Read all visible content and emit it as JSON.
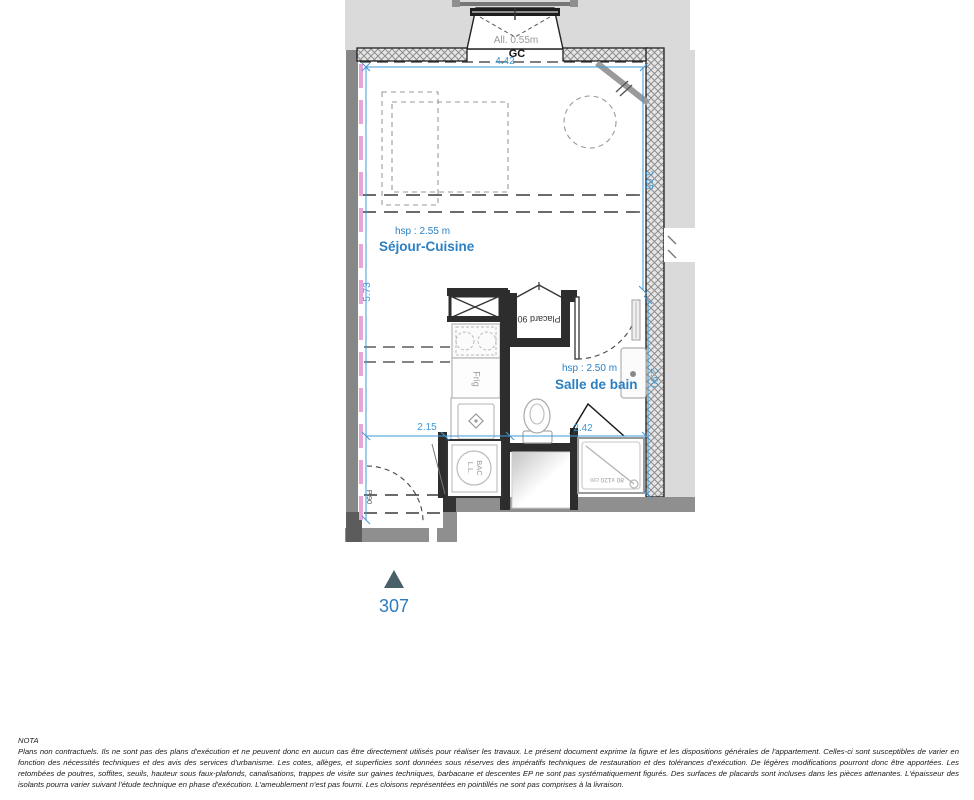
{
  "colors": {
    "dimension_blue": "#3f9ad6",
    "label_blue": "#2b80c4",
    "insulation_pink": "#e7a6da",
    "exterior_gray": "#dadada",
    "wall_gray": "#8f8f8f",
    "dark_wall": "#2d2d2d",
    "entrance_marker": "#4a6068"
  },
  "plan": {
    "window": {
      "sill_label": "All. 0.55m",
      "gc_label": "GC"
    },
    "rooms": {
      "sejour": {
        "name": "Séjour-Cuisine",
        "height_label": "hsp : 2.55 m"
      },
      "bathroom": {
        "name": "Salle de bain",
        "height_label": "hsp : 2.50 m"
      }
    },
    "fixtures": {
      "placard": "Placard 90",
      "fridge": "Frig",
      "washer_line1": "BAC",
      "washer_line2": "L.L.",
      "shower": "80 x120 cm",
      "entry_door": "P.90"
    },
    "dimensions": {
      "width_top": "4.42",
      "height_left": "5.73",
      "height_right_upper": "3.65",
      "height_right_lower": "2.90",
      "width_bottom_left": "2.15",
      "width_bottom_right": "2.42"
    },
    "unit_number": "307"
  },
  "nota": {
    "title": "NOTA",
    "body": "Plans non contractuels. Ils ne sont pas des plans d'exécution et ne peuvent donc en aucun cas être directement utilisés pour réaliser les travaux. Le présent document exprime la figure et les dispositions générales de l'appartement. Celles-ci sont susceptibles de varier en fonction des nécessités techniques et des avis des services d'urbanisme. Les cotes, allèges, et superficies sont données sous réserves des impératifs techniques de restauration et des tolérances d'exécution. De légères modifications pourront donc être apportées. Les retombées de poutres, soffites, seuils, hauteur sous faux-plafonds, canalisations, trappes de visite sur gaines techniques, barbacane et descentes EP ne sont pas systématiquement figurés. Des surfaces de placards sont incluses dans les pièces attenantes. L'épaisseur des isolants pourra varier suivant l'étude technique en phase d'exécution. L'ameublement n'est pas fourni. Les cloisons représentées en pointillés ne sont pas comprises à la livraison."
  }
}
